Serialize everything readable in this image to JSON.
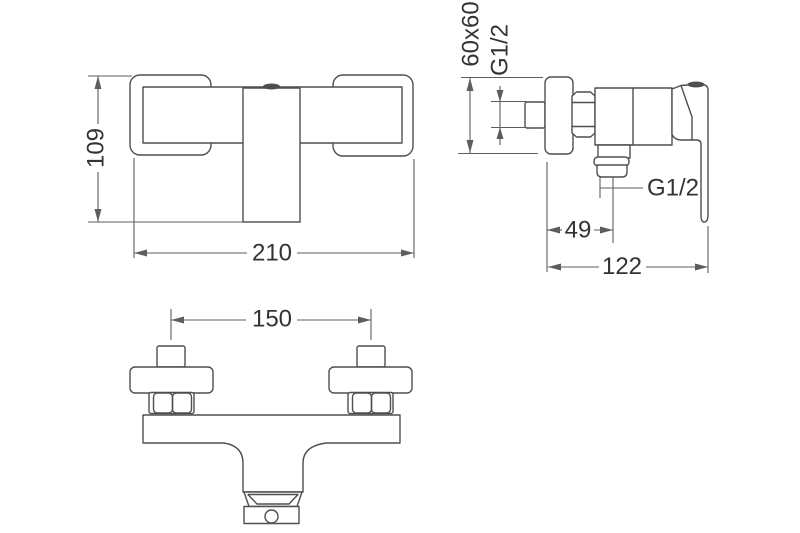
{
  "drawing_title": "shower-mixer-technical-drawing",
  "colors": {
    "line": "#4f4f4f",
    "dimension": "#5d5d5d",
    "text": "#333333",
    "background": "#ffffff"
  },
  "views": {
    "front": {
      "height": "109",
      "width": "210"
    },
    "side": {
      "plate": "60x60",
      "inlet_thread": "G1/2",
      "outlet_thread": "G1/2",
      "outlet_offset": "49",
      "depth": "122"
    },
    "bottom": {
      "hole_spacing": "150"
    }
  }
}
